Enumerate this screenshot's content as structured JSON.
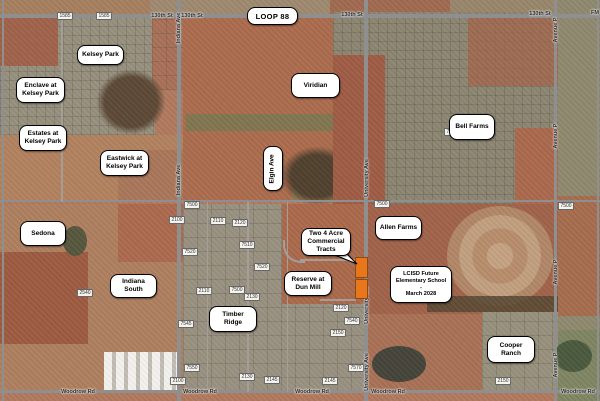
{
  "map": {
    "width": 600,
    "height": 401,
    "colors": {
      "tract_highlight": "#E8761A",
      "label_background": "#FFFFFF",
      "label_border": "#000000",
      "road_gray": "#8F8F8F"
    },
    "region_labels": [
      {
        "id": "loop-88",
        "lines": [
          "LOOP 88"
        ],
        "x": 247,
        "y": 7,
        "w": 51,
        "h": 18,
        "big": true
      },
      {
        "id": "kelsey-park",
        "lines": [
          "Kelsey Park"
        ],
        "x": 77,
        "y": 45,
        "w": 47,
        "h": 20
      },
      {
        "id": "enclave-at-kelsey-park",
        "lines": [
          "Enclave at",
          "Kelsey Park"
        ],
        "x": 16,
        "y": 77,
        "w": 49,
        "h": 26
      },
      {
        "id": "estates-at-kelsey-park",
        "lines": [
          "Estates at",
          "Kelsey Park"
        ],
        "x": 19,
        "y": 125,
        "w": 48,
        "h": 26
      },
      {
        "id": "eastwick-at-kelsey-park",
        "lines": [
          "Eastwick at",
          "Kelsey Park"
        ],
        "x": 100,
        "y": 150,
        "w": 49,
        "h": 26
      },
      {
        "id": "viridian",
        "lines": [
          "Viridian"
        ],
        "x": 291,
        "y": 73,
        "w": 49,
        "h": 25
      },
      {
        "id": "bell-farms",
        "lines": [
          "Bell Farms"
        ],
        "x": 449,
        "y": 114,
        "w": 46,
        "h": 26
      },
      {
        "id": "elgin-ave",
        "lines": [
          "Elgin Ave"
        ],
        "x": 263,
        "y": 146,
        "w": 20,
        "h": 45,
        "vertical": true
      },
      {
        "id": "sedona",
        "lines": [
          "Sedona"
        ],
        "x": 20,
        "y": 221,
        "w": 46,
        "h": 25
      },
      {
        "id": "indiana-south",
        "lines": [
          "Indiana",
          "South"
        ],
        "x": 110,
        "y": 274,
        "w": 47,
        "h": 24
      },
      {
        "id": "timber-ridge",
        "lines": [
          "Timber",
          "Ridge"
        ],
        "x": 209,
        "y": 306,
        "w": 48,
        "h": 26
      },
      {
        "id": "allen-farms",
        "lines": [
          "Allen Farms"
        ],
        "x": 375,
        "y": 216,
        "w": 47,
        "h": 24
      },
      {
        "id": "two-4-acre-commercial-tracts",
        "lines": [
          "Two 4 Acre",
          "Commercial",
          "Tracts"
        ],
        "x": 301,
        "y": 228,
        "w": 50,
        "h": 28,
        "tail": true
      },
      {
        "id": "reserve-at-dun-mill",
        "lines": [
          "Reserve at",
          "Dun Mill"
        ],
        "x": 284,
        "y": 271,
        "w": 48,
        "h": 25
      },
      {
        "id": "lcisd-future-elementary-school",
        "lines": [
          "LCISD Future",
          "Elementary School",
          "-",
          "March 2028"
        ],
        "x": 390,
        "y": 266,
        "w": 62,
        "h": 37,
        "small": true
      },
      {
        "id": "cooper-ranch",
        "lines": [
          "Cooper",
          "Ranch"
        ],
        "x": 487,
        "y": 336,
        "w": 48,
        "h": 27
      }
    ],
    "callout_tail_points": "332,254 357,264 343,250",
    "road_labels": [
      {
        "text": "130th St",
        "x": 162,
        "y": 16
      },
      {
        "text": "130th St",
        "x": 192,
        "y": 16
      },
      {
        "text": "130th St",
        "x": 352,
        "y": 15
      },
      {
        "text": "130th St",
        "x": 540,
        "y": 14
      },
      {
        "text": "FM",
        "x": 595,
        "y": 13
      },
      {
        "text": "Woodrow Rd",
        "x": 78,
        "y": 392
      },
      {
        "text": "Woodrow Rd",
        "x": 200,
        "y": 392
      },
      {
        "text": "Woodrow Rd",
        "x": 312,
        "y": 392
      },
      {
        "text": "Woodrow Rd",
        "x": 388,
        "y": 392
      },
      {
        "text": "Woodrow Rd",
        "x": 578,
        "y": 392
      },
      {
        "text": "Indiana Ave",
        "x": 179,
        "y": 28,
        "vertical": true
      },
      {
        "text": "Indiana Ave",
        "x": 179,
        "y": 180,
        "vertical": true
      },
      {
        "text": "University Ave",
        "x": 367,
        "y": 178,
        "vertical": true
      },
      {
        "text": "University Ave",
        "x": 367,
        "y": 305,
        "vertical": true
      },
      {
        "text": "University Ave",
        "x": 367,
        "y": 372,
        "vertical": true
      },
      {
        "text": "Avenue P",
        "x": 556,
        "y": 30,
        "vertical": true
      },
      {
        "text": "Avenue P",
        "x": 556,
        "y": 136,
        "vertical": true
      },
      {
        "text": "Avenue P",
        "x": 556,
        "y": 272,
        "vertical": true
      },
      {
        "text": "Avenue P",
        "x": 556,
        "y": 365,
        "vertical": true
      }
    ],
    "shields": [
      {
        "text": "1585",
        "x": 65,
        "y": 16
      },
      {
        "text": "1585",
        "x": 104,
        "y": 16
      },
      {
        "text": "7050",
        "x": 452,
        "y": 132
      },
      {
        "text": "7500",
        "x": 192,
        "y": 205
      },
      {
        "text": "7500",
        "x": 382,
        "y": 204
      },
      {
        "text": "7500",
        "x": 566,
        "y": 206
      },
      {
        "text": "2100",
        "x": 177,
        "y": 220
      },
      {
        "text": "2110",
        "x": 218,
        "y": 221
      },
      {
        "text": "2120",
        "x": 240,
        "y": 223
      },
      {
        "text": "7510",
        "x": 247,
        "y": 245
      },
      {
        "text": "7520",
        "x": 190,
        "y": 252
      },
      {
        "text": "7520",
        "x": 262,
        "y": 267
      },
      {
        "text": "2540",
        "x": 85,
        "y": 293
      },
      {
        "text": "2110",
        "x": 204,
        "y": 291
      },
      {
        "text": "7500",
        "x": 237,
        "y": 290
      },
      {
        "text": "2130",
        "x": 252,
        "y": 297
      },
      {
        "text": "2120",
        "x": 341,
        "y": 308
      },
      {
        "text": "2150",
        "x": 338,
        "y": 333
      },
      {
        "text": "7540",
        "x": 352,
        "y": 321
      },
      {
        "text": "7545",
        "x": 186,
        "y": 324
      },
      {
        "text": "7550",
        "x": 192,
        "y": 368
      },
      {
        "text": "7570",
        "x": 356,
        "y": 368
      },
      {
        "text": "2100",
        "x": 178,
        "y": 381
      },
      {
        "text": "2130",
        "x": 247,
        "y": 377
      },
      {
        "text": "2145",
        "x": 272,
        "y": 380
      },
      {
        "text": "2145",
        "x": 330,
        "y": 381
      },
      {
        "text": "2150",
        "x": 503,
        "y": 381
      }
    ],
    "tracts": [
      {
        "x": 355,
        "y": 257,
        "w": 13,
        "h": 21
      },
      {
        "x": 355,
        "y": 279,
        "w": 13,
        "h": 20
      }
    ],
    "roads": [
      {
        "name": "130th-st",
        "x": 0,
        "y": 14,
        "w": 600,
        "h": 4
      },
      {
        "name": "mid-section-road",
        "x": 0,
        "y": 200,
        "w": 600,
        "h": 2
      },
      {
        "name": "woodrow-rd",
        "x": 0,
        "y": 390,
        "w": 600,
        "h": 3
      },
      {
        "name": "west-edge-road",
        "x": 2,
        "y": 0,
        "w": 2,
        "h": 401
      },
      {
        "name": "indiana-ave",
        "x": 177,
        "y": 0,
        "w": 4,
        "h": 401
      },
      {
        "name": "university-ave",
        "x": 364,
        "y": 0,
        "w": 4,
        "h": 401
      },
      {
        "name": "avenue-p",
        "x": 554,
        "y": 0,
        "w": 3,
        "h": 401
      },
      {
        "name": "east-edge-road",
        "x": 597,
        "y": 0,
        "w": 2,
        "h": 401
      },
      {
        "name": "minor-street-1",
        "x": 61,
        "y": 18,
        "w": 2,
        "h": 184,
        "minor": true
      },
      {
        "name": "minor-street-2",
        "x": 247,
        "y": 202,
        "w": 2,
        "h": 190,
        "minor": true
      },
      {
        "name": "minor-street-3",
        "x": 207,
        "y": 202,
        "w": 1,
        "h": 190,
        "minor": true
      },
      {
        "name": "minor-street-4",
        "x": 287,
        "y": 202,
        "w": 1,
        "h": 190,
        "minor": true
      },
      {
        "name": "dunmill-street-north",
        "x": 300,
        "y": 259,
        "w": 56,
        "h": 2,
        "minor": true
      },
      {
        "name": "dunmill-street-south",
        "x": 320,
        "y": 299,
        "w": 36,
        "h": 2,
        "minor": true
      }
    ]
  }
}
